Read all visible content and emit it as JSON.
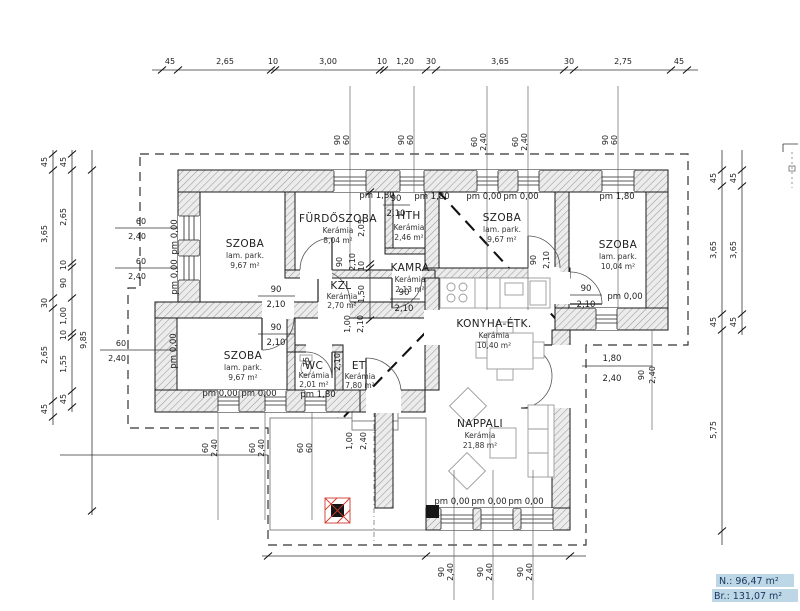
{
  "plan": {
    "rooms": {
      "szoba_nw": {
        "name": "SZOBA",
        "finish": "lam. park.",
        "area": "9,67 m²"
      },
      "furdoszoba": {
        "name": "FÜRDŐSZOBA",
        "finish": "Kerámia",
        "area": "8,04 m²"
      },
      "hth": {
        "name": "HTH",
        "finish": "Kerámia",
        "area": "2,46 m²"
      },
      "kamra": {
        "name": "KAMRA",
        "finish": "Kerámia",
        "area": "2,13 m²"
      },
      "kzl": {
        "name": "KZL",
        "finish": "Kerámia",
        "area": "2,70 m²"
      },
      "szoba_n": {
        "name": "SZOBA",
        "finish": "lam. park.",
        "area": "9,67 m²"
      },
      "szoba_ne": {
        "name": "SZOBA",
        "finish": "lam. park.",
        "area": "10,04 m²"
      },
      "konyha": {
        "name": "KONYHA-ÉTK.",
        "finish": "Kerámia",
        "area": "10,40 m²"
      },
      "szoba_sw": {
        "name": "SZOBA",
        "finish": "lam. park.",
        "area": "9,67 m²"
      },
      "wc": {
        "name": "WC",
        "finish": "Kerámia",
        "area": "2,01 m²"
      },
      "et": {
        "name": "ET.",
        "finish": "Kerámia",
        "area": "7,80 m²"
      },
      "nappali": {
        "name": "NAPPALI",
        "finish": "Kerámia",
        "area": "21,88 m²"
      }
    },
    "summary": {
      "net": "N.: 96,47 m²",
      "gross": "Br.: 131,07 m²"
    },
    "levels": {
      "zero": "pm 0,00",
      "high": "pm 1,80"
    },
    "dims": {
      "top": [
        "45",
        "2,65",
        "10",
        "3,00",
        "10",
        "1,20",
        "30",
        "3,65",
        "30",
        "2,75",
        "45"
      ],
      "left_outer": [
        "45",
        "3,65",
        "30",
        "2,65",
        "45"
      ],
      "left_mid": [
        "45",
        "2,65",
        "10",
        "90",
        "1,00",
        "10",
        "1,55",
        "45"
      ],
      "left_overall": "9,85",
      "right_inner": [
        "45",
        "3,65",
        "45",
        "5,75"
      ],
      "right_outer": [
        "45",
        "3,65",
        "45"
      ],
      "mid_vertical": [
        "2,05",
        "10",
        "1,50"
      ]
    },
    "doors": {
      "d90": {
        "w": "90",
        "h": "2,10"
      },
      "d75": {
        "w": "75",
        "h": "2,10"
      },
      "d100": {
        "w": "1,00",
        "h": "2,10"
      },
      "entry": {
        "w": "1,00",
        "h": "2,40"
      },
      "terrace": {
        "w": "1,80",
        "h": "2,40"
      }
    },
    "windows": {
      "w9060": {
        "w": "90",
        "h": "60"
      },
      "w60240": {
        "w": "60",
        "h": "2,40"
      },
      "w90240": {
        "w": "90",
        "h": "2,40"
      },
      "w6060": {
        "w": "60",
        "h": "60"
      }
    }
  }
}
